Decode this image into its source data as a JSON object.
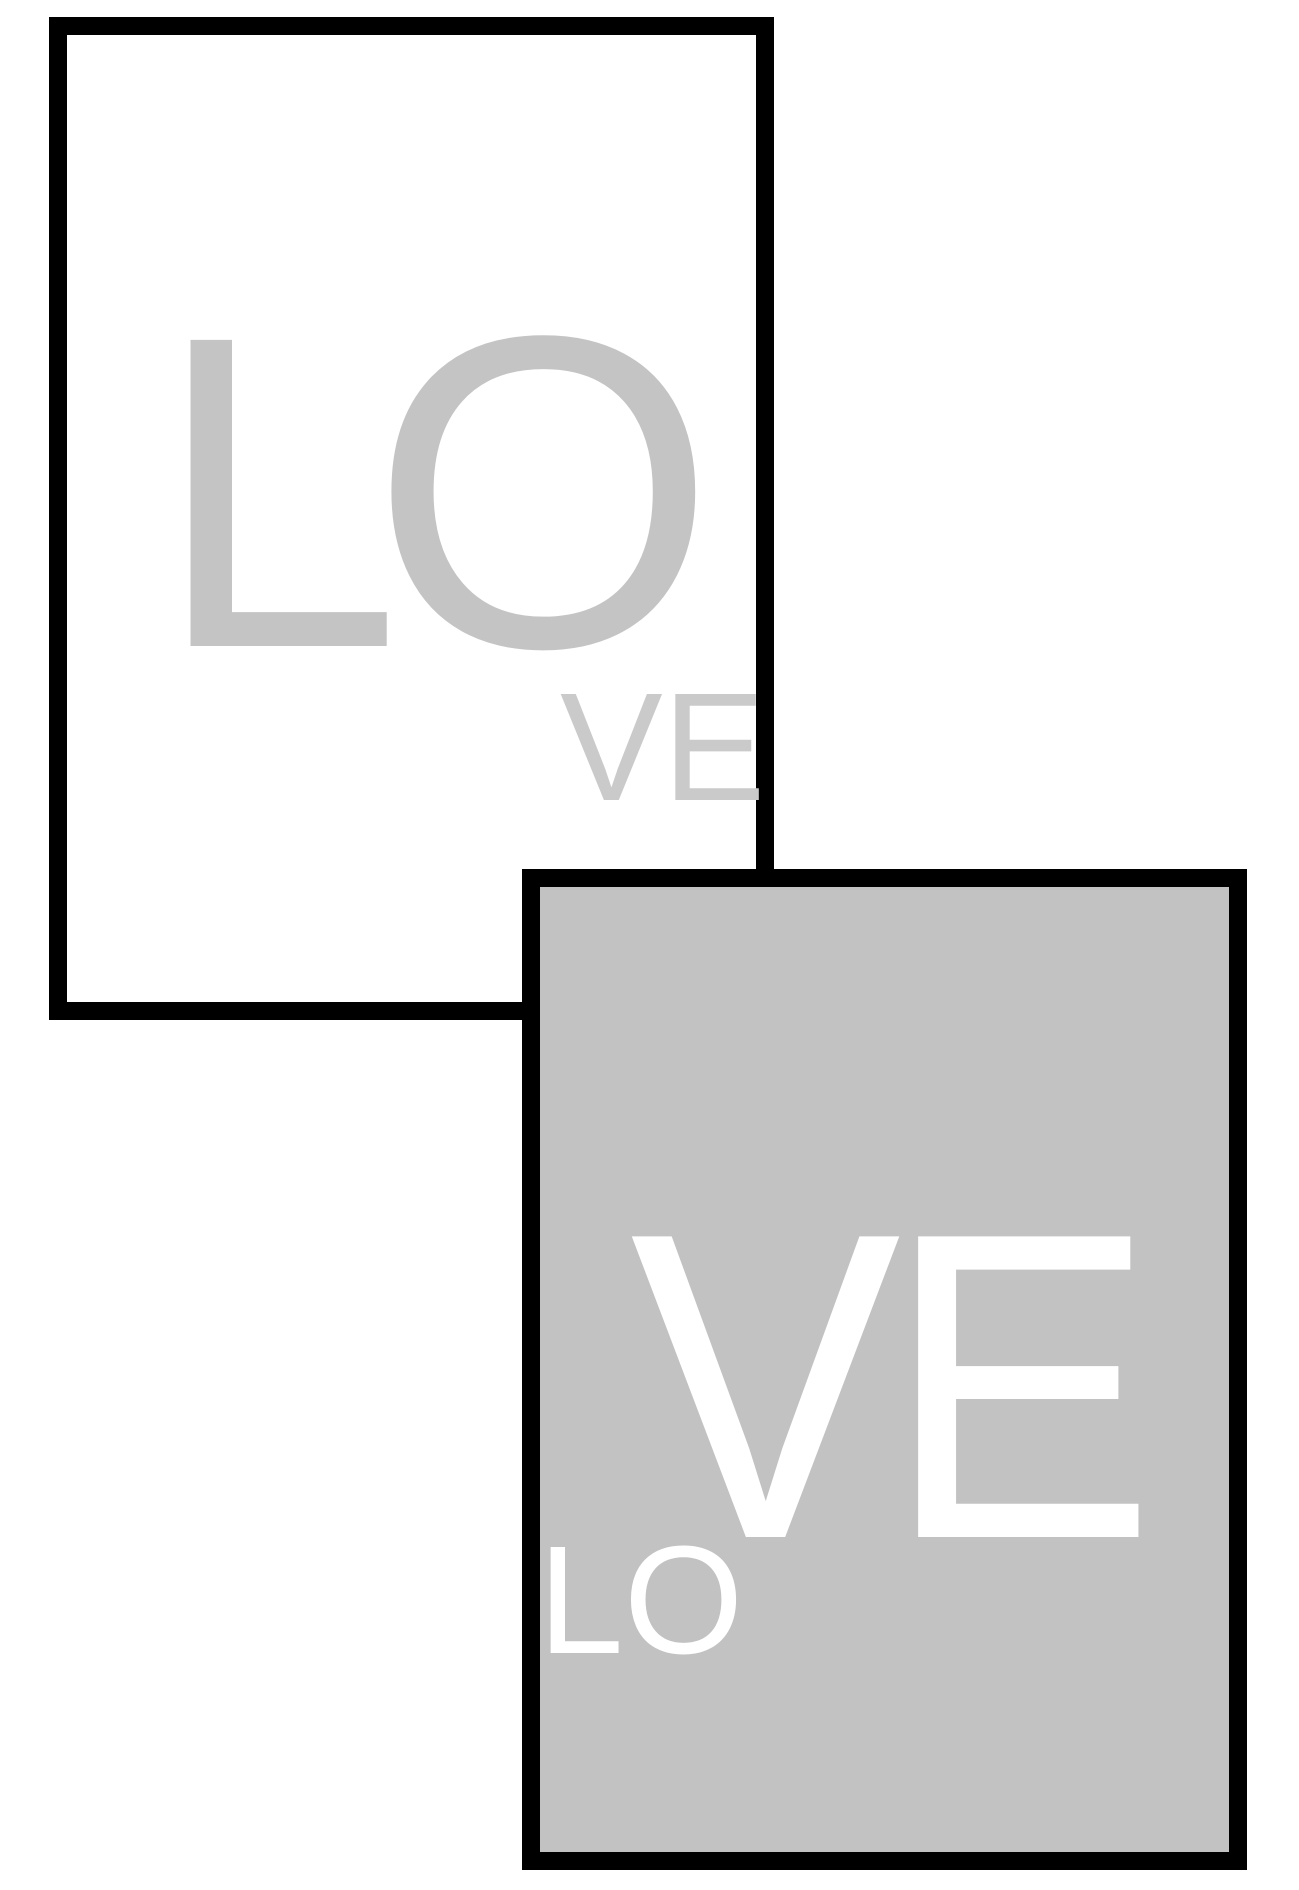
{
  "scene": {
    "description": "Two overlapping framed LOVE art prints",
    "background": "#ffffff",
    "frame_color": "#000000"
  },
  "posters": {
    "white": {
      "background": "#ffffff",
      "big_text": "LO",
      "big_text_color": "#c4c4c4",
      "small_text": "VE",
      "small_text_color": "#cacaca"
    },
    "gray": {
      "background": "#c2c2c2",
      "big_text": "VE",
      "small_text": "LO",
      "text_color": "#ffffff"
    }
  }
}
